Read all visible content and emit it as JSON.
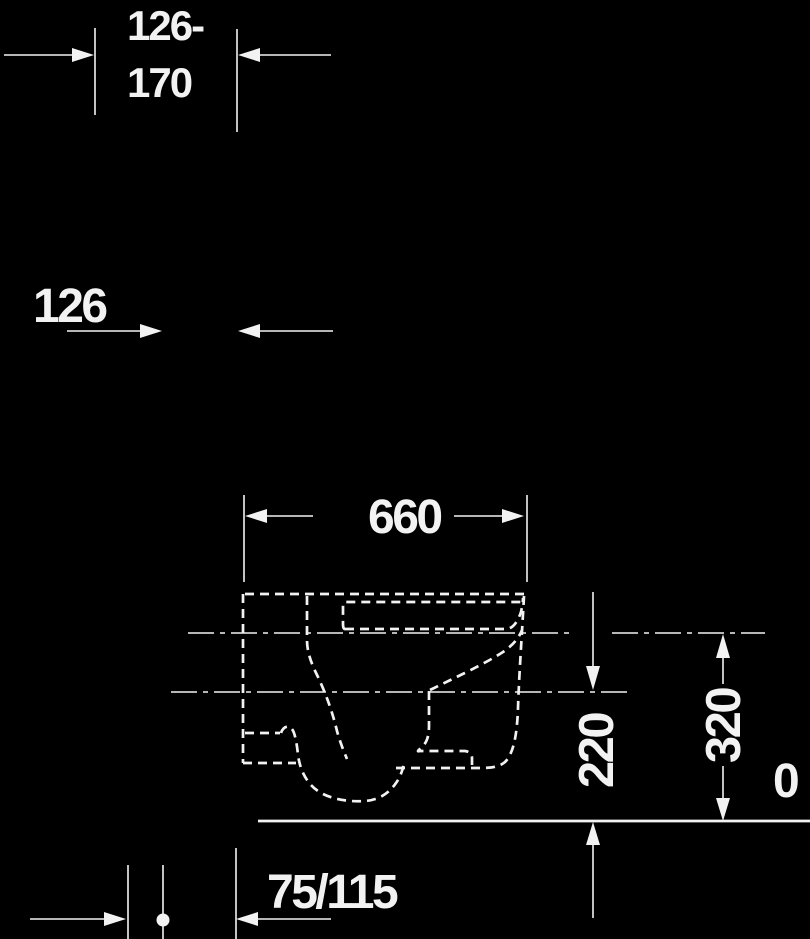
{
  "meta": {
    "title": "Wall-hung toilet installation drawing, side elevation",
    "drawing_type": "technical-dimension-diagram"
  },
  "colors": {
    "background": "#000000",
    "ink": "#f2f2f2"
  },
  "labels": {
    "range_top": "126-",
    "range_bottom": "170",
    "offset": "126",
    "width": "660",
    "outlet_height": "220",
    "inlet_height": "320",
    "zero": "0",
    "outlet_distance": "75/115"
  },
  "dimensions_semantics": {
    "range": "126-170",
    "offset": "126",
    "product_depth": "660",
    "outlet_axis_height": "220",
    "supply_axis_height": "320",
    "floor_level": "0",
    "pipe_to_wall_distance": "75/115"
  }
}
